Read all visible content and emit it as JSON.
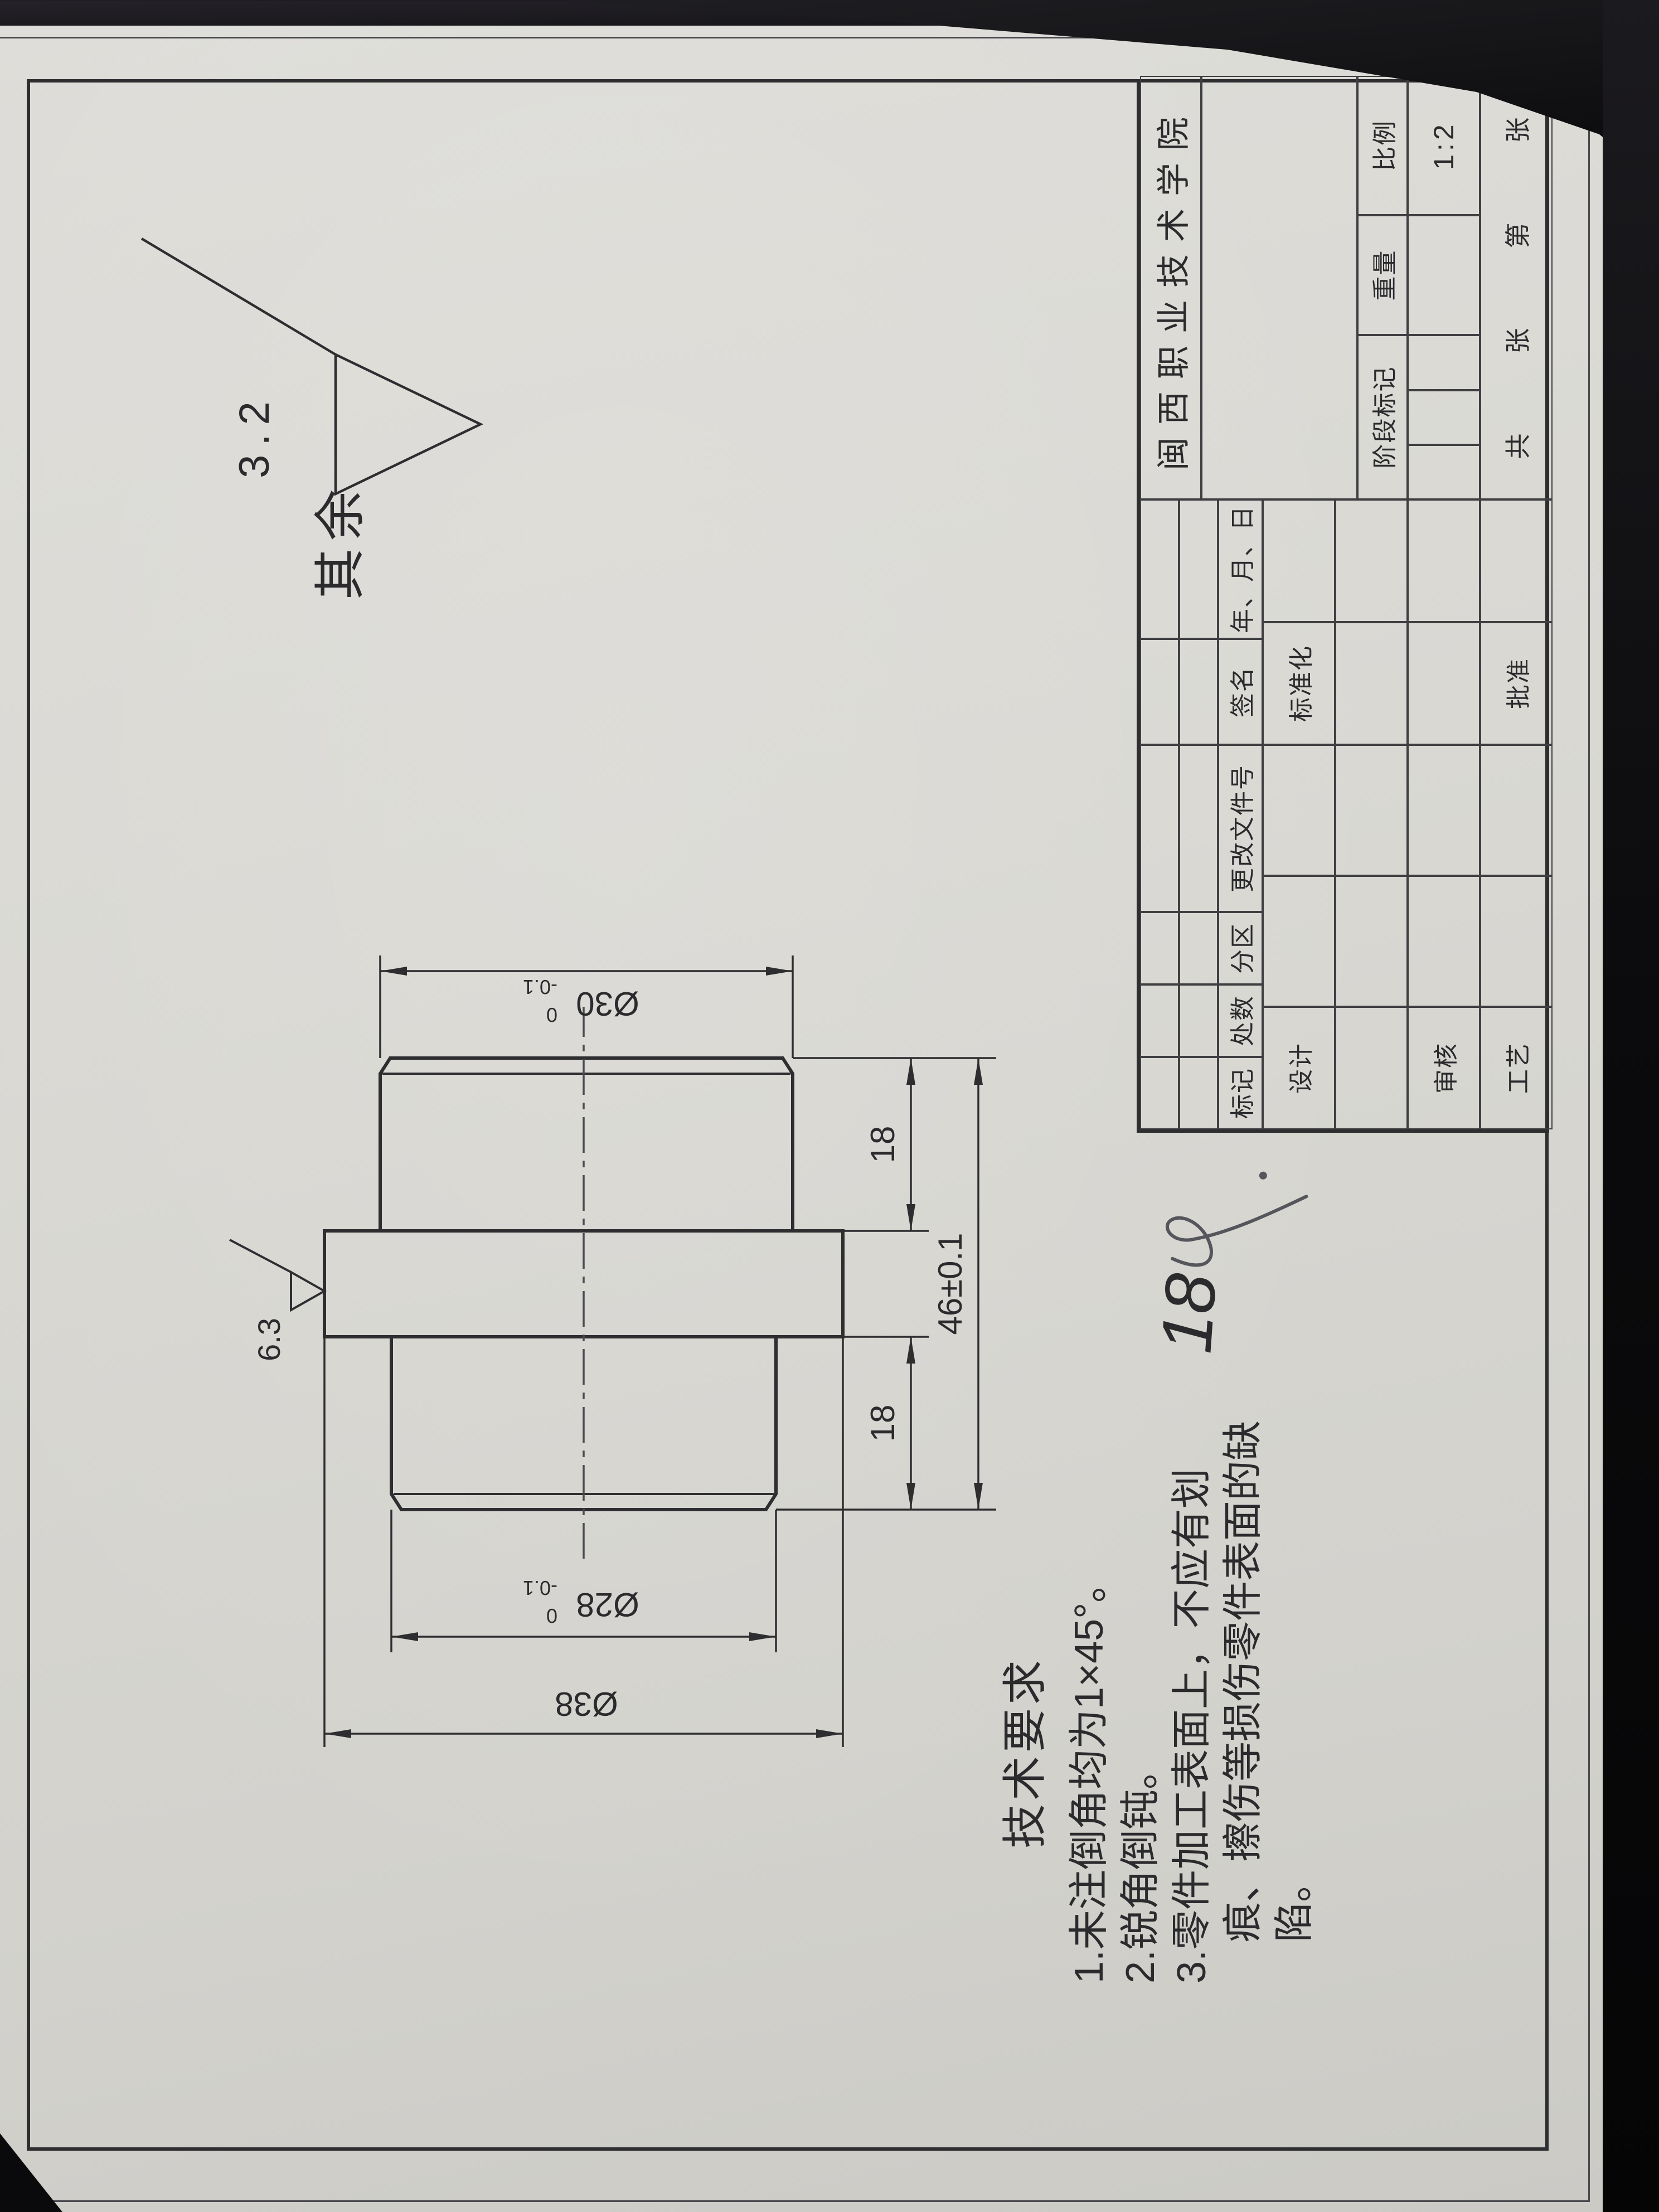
{
  "general_note": {
    "label": "其余",
    "roughness": "3.2"
  },
  "view": {
    "roughness_flange": "6.3",
    "dims": {
      "d30": {
        "text": "Ø30",
        "sup": "0",
        "sub": "-0.1"
      },
      "d28": {
        "text": "Ø28",
        "sup": "0",
        "sub": "-0.1"
      },
      "d38": {
        "text": "Ø38"
      },
      "len_right": "18",
      "len_left": "18",
      "len_total": "46±0.1"
    }
  },
  "tech": {
    "heading": "技术要求",
    "lines": [
      "1.未注倒角均为1×45°。",
      "2.锐角倒钝。",
      "3.零件加工表面上，不应有划",
      "痕、擦伤等损伤零件表面的缺",
      "陷。"
    ]
  },
  "title_block": {
    "school": "闽西职业技术学院",
    "rev_headers": [
      "标记",
      "处数",
      "分区",
      "更改文件号",
      "签名",
      "年、月、日"
    ],
    "design": "设计",
    "standardization": "标准化",
    "check": "审核",
    "process": "工艺",
    "approve": "批准",
    "stage": "阶段标记",
    "weight": "重量",
    "scale": "比例",
    "scale_value": "1:2",
    "sheets": [
      "共",
      "张",
      "第",
      "张"
    ]
  },
  "handwriting": {
    "score": "18"
  }
}
